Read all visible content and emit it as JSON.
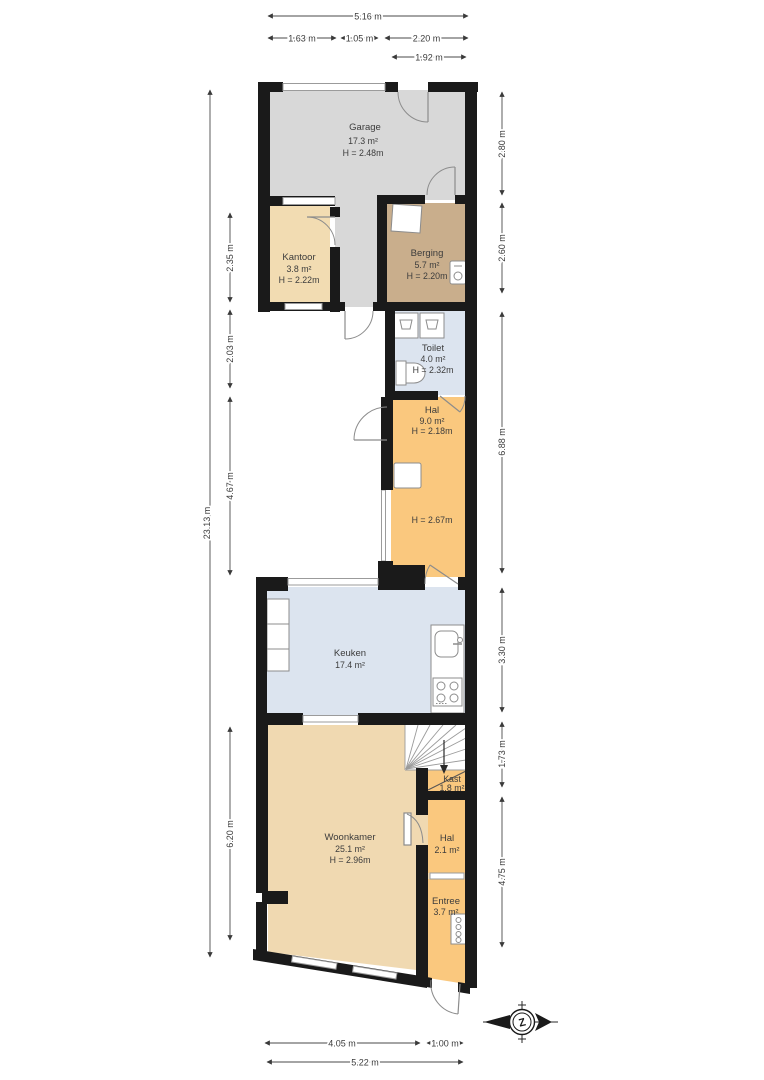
{
  "rooms": {
    "garage": {
      "name": "Garage",
      "area": "17.3 m²",
      "height": "H = 2.48m"
    },
    "kantoor": {
      "name": "Kantoor",
      "area": "3.8 m²",
      "height": "H = 2.22m"
    },
    "berging": {
      "name": "Berging",
      "area": "5.7 m²",
      "height": "H = 2.20m"
    },
    "toilet": {
      "name": "Toilet",
      "area": "4.0 m²",
      "height": "H = 2.32m"
    },
    "hal_boven": {
      "name": "Hal",
      "area": "9.0 m²",
      "height": "H = 2.18m",
      "height2": "H = 2.67m"
    },
    "keuken": {
      "name": "Keuken",
      "area": "17.4 m²"
    },
    "woonkamer": {
      "name": "Woonkamer",
      "area": "25.1 m²",
      "height": "H = 2.96m"
    },
    "kast": {
      "name": "Kast",
      "area": "1.8 m²"
    },
    "hal_beneden": {
      "name": "Hal",
      "area": "2.1 m²"
    },
    "entree": {
      "name": "Entree",
      "area": "3.7 m²"
    }
  },
  "dimensions": {
    "top": [
      "5.16 m",
      "1.63 m",
      "1.05 m",
      "2.20 m",
      "1.92 m"
    ],
    "left": [
      "23.13 m",
      "2.35 m",
      "2.03 m",
      "4.67 m",
      "6.20 m"
    ],
    "right": [
      "2.80 m",
      "2.60 m",
      "6.88 m",
      "3.30 m",
      "1.73 m",
      "4.75 m"
    ],
    "bottom": [
      "4.05 m",
      "1.00 m",
      "5.22 m"
    ]
  },
  "compass": {
    "label": "Z"
  },
  "palette": {
    "wall": "#1a1a1a",
    "garage": "#d8d8d8",
    "kantoor": "#f2dcb2",
    "berging": "#c9ae8c",
    "wet_rooms": "#dce4ef",
    "hal": "#fac87e",
    "woonkamer": "#f0d9b1"
  }
}
